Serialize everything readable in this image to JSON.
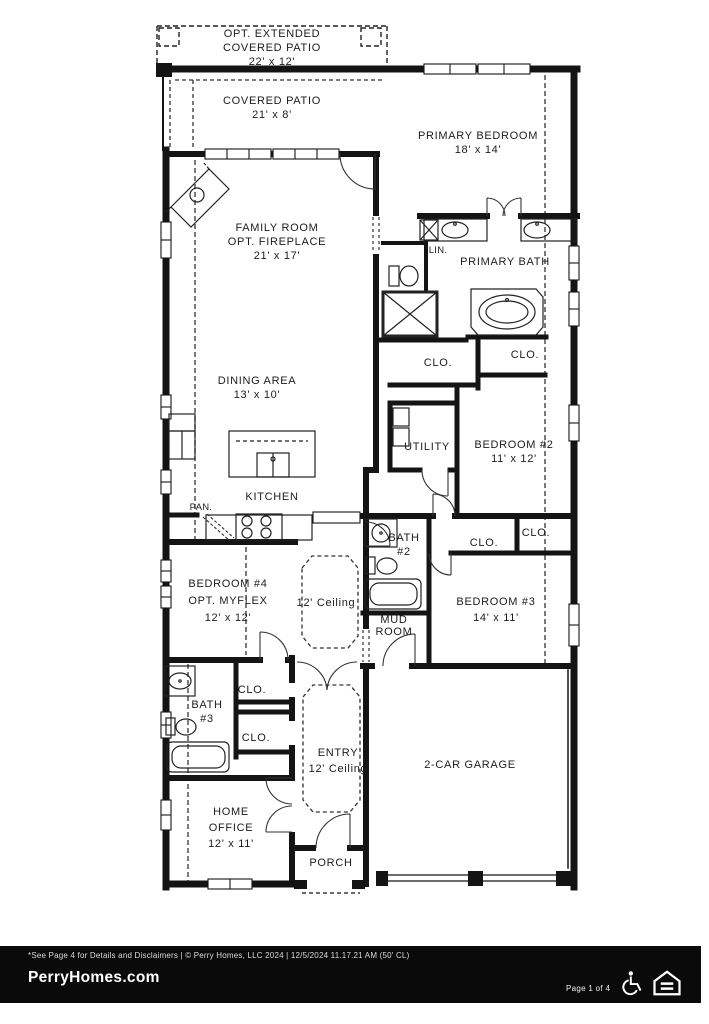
{
  "labels": {
    "opt_patio_1": "OPT. EXTENDED",
    "opt_patio_2": "COVERED PATIO",
    "opt_patio_dims": "22' x 12'",
    "covered_patio": "COVERED PATIO",
    "covered_patio_dims": "21' x 8'",
    "primary_bedroom": "PRIMARY BEDROOM",
    "primary_bedroom_dims": "18' x 14'",
    "family_room_1": "FAMILY ROOM",
    "family_room_2": "OPT. FIREPLACE",
    "family_room_dims": "21' x 17'",
    "lin": "LIN.",
    "primary_bath": "PRIMARY BATH",
    "clo": "CLO.",
    "dining_area": "DINING AREA",
    "dining_dims": "13' x 10'",
    "utility": "UTILITY",
    "bedroom2": "BEDROOM #2",
    "bedroom2_dims": "11' x 12'",
    "kitchen": "KITCHEN",
    "pantry": "PAN.",
    "bath2_1": "BATH",
    "bath2_2": "#2",
    "bedroom4_1": "BEDROOM #4",
    "bedroom4_2": "OPT. MYFLEX",
    "bedroom4_dims": "12' x 12'",
    "ceiling12": "12' Ceiling",
    "mud_1": "MUD",
    "mud_2": "ROOM",
    "bedroom3": "BEDROOM #3",
    "bedroom3_dims": "14' x 11'",
    "bath3_1": "BATH",
    "bath3_2": "#3",
    "entry": "ENTRY",
    "entry_sub": "12' Ceiling",
    "garage": "2-CAR GARAGE",
    "office_1": "HOME",
    "office_2": "OFFICE",
    "office_dims": "12' x 11'",
    "porch": "PORCH"
  },
  "footer": {
    "disclaimer": "*See Page 4 for Details and Disclaimers  |  © Perry Homes, LLC 2024  |  12/5/2024 11.17.21 AM (50' CL)",
    "brand": "PerryHomes.com",
    "page": "Page 1 of 4",
    "accessibility_icon": "wheelchair-accessible",
    "equal_housing_icon": "equal-housing-opportunity"
  }
}
